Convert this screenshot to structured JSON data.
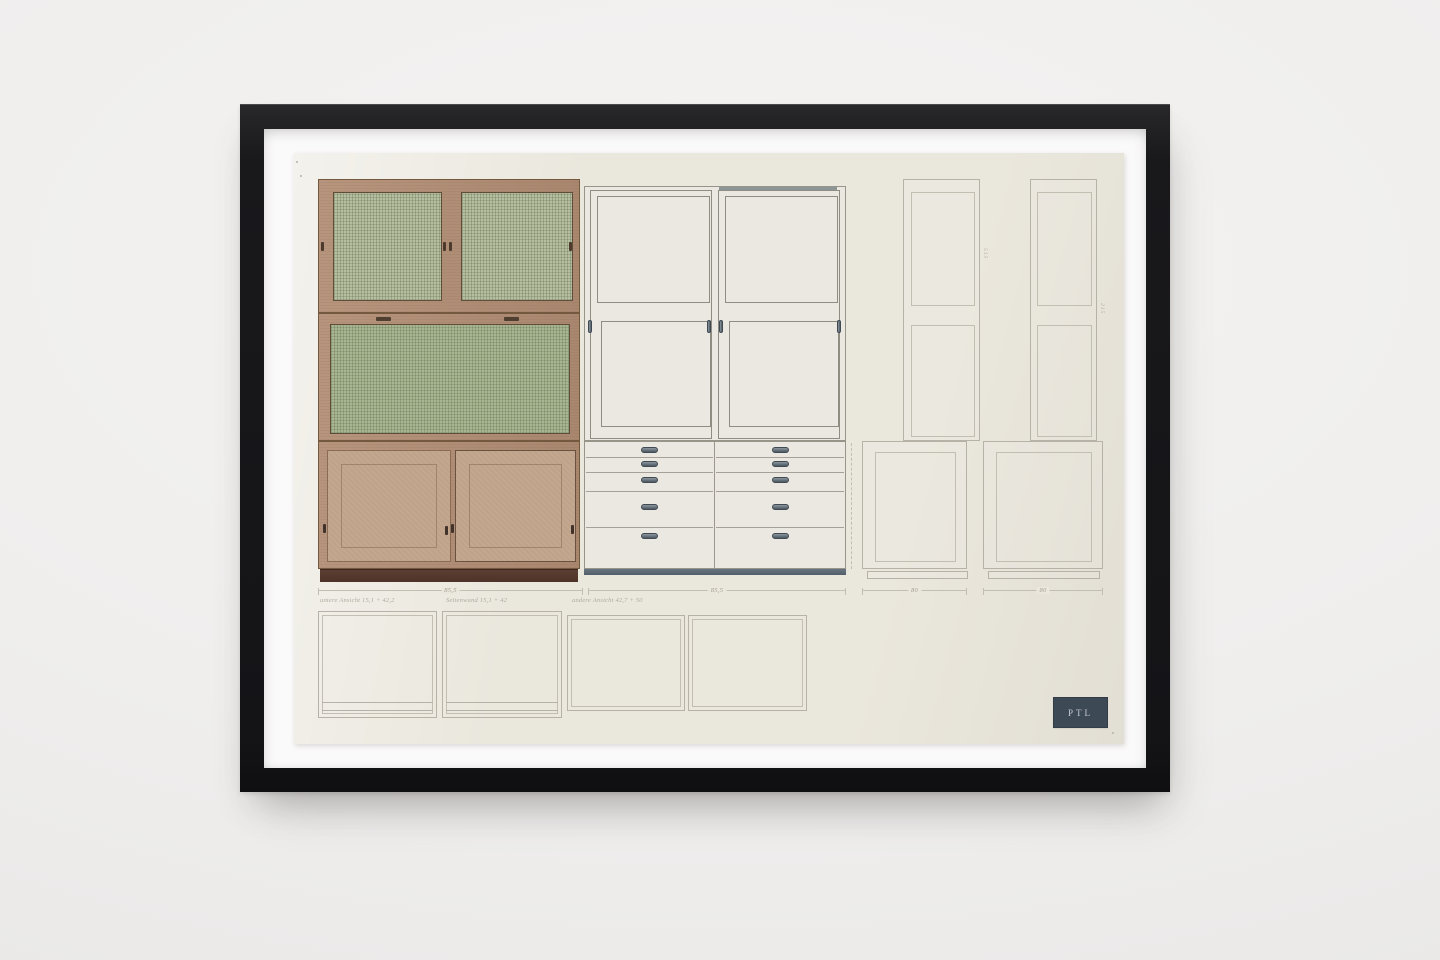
{
  "stamp": {
    "label": "PTL"
  },
  "dimensions": {
    "left_cabinet_width": "85,5",
    "middle_cabinet_width": "85,5",
    "square_c_width": "80",
    "square_d_width": "80",
    "panel_a_height": "515",
    "panel_b_height": "215"
  },
  "annotations": {
    "plan_1": "untere Ansicht 15,1 + 42,2",
    "plan_2": "Seitenwand 15,1 + 42",
    "plan_3": "andere Ansicht 42,7 + 50"
  },
  "colors": {
    "wall": "#f0efee",
    "frame": "#1c1c1f",
    "mat": "#fbfafa",
    "paper": "#eae7dd",
    "wood": "#b28e75",
    "mesh_green": "#a9b694",
    "door_tan": "#c3a78f",
    "plinth_brown": "#573a2e",
    "cabinet_white": "#eae8e0",
    "handle_steel": "#5d6973",
    "pencil_gray": "#b6b2a7",
    "stamp_background": "#3e4956",
    "stamp_text": "#c7ccd3"
  }
}
